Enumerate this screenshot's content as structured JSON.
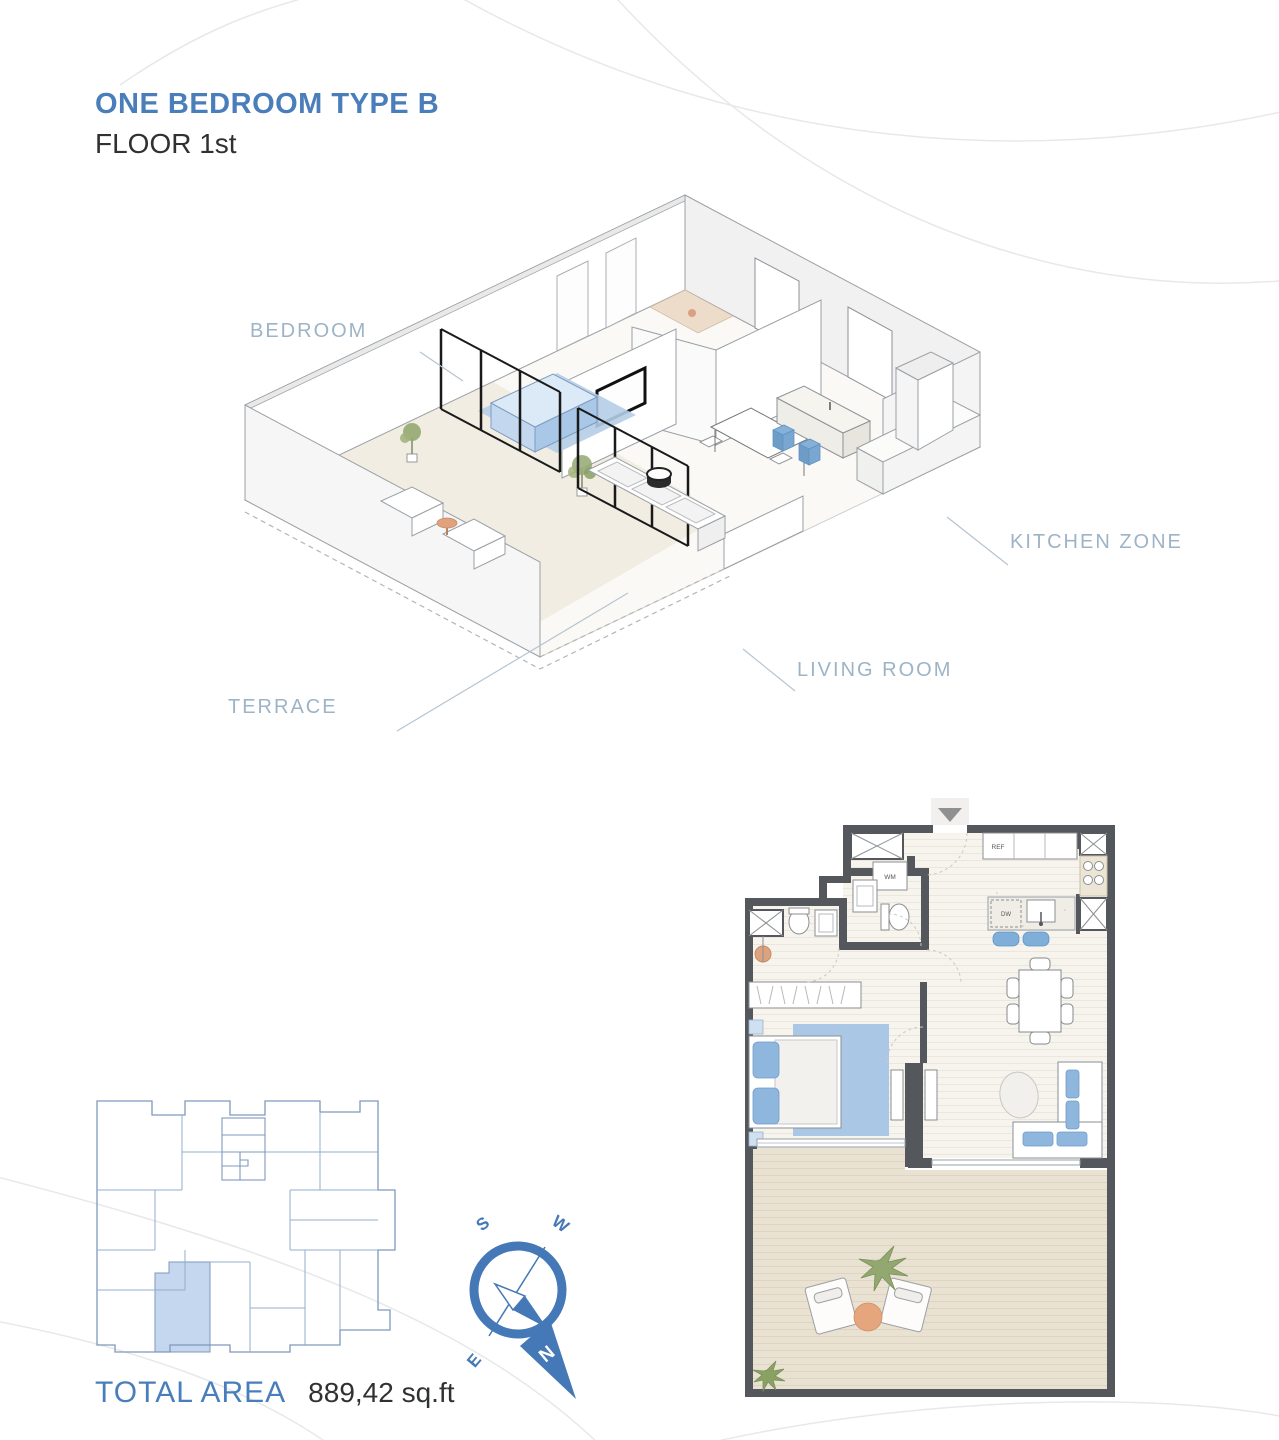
{
  "header": {
    "title": "ONE BEDROOM TYPE B",
    "subtitle": "FLOOR 1st"
  },
  "iso_labels": {
    "bedroom": "BEDROOM",
    "kitchen": "KITCHEN ZONE",
    "living": "LIVING ROOM",
    "terrace": "TERRACE"
  },
  "plan": {
    "wm": "WM",
    "ref": "REF",
    "dw": "DW"
  },
  "compass": {
    "n": "N",
    "s": "S",
    "e": "E",
    "w": "W"
  },
  "footer": {
    "total_area_label": "TOTAL AREA",
    "total_area_value": "889,42 sq.ft"
  },
  "colors": {
    "accent_blue": "#4a7ebb",
    "label_blue_gray": "#9db3c6",
    "wall_gray": "#54575b",
    "terrace_floor": "#e9e1d1",
    "interior_floor": "#f7f4ee",
    "furniture_blue": "#8fb7dd",
    "rug_blue": "#aac8e6",
    "keyplan_line": "#8ca6c6",
    "keyplan_highlight": "#c4d7ee",
    "compass_blue": "#4478b6",
    "plant_green": "#93a871",
    "wood_tan": "#e5a67d"
  }
}
